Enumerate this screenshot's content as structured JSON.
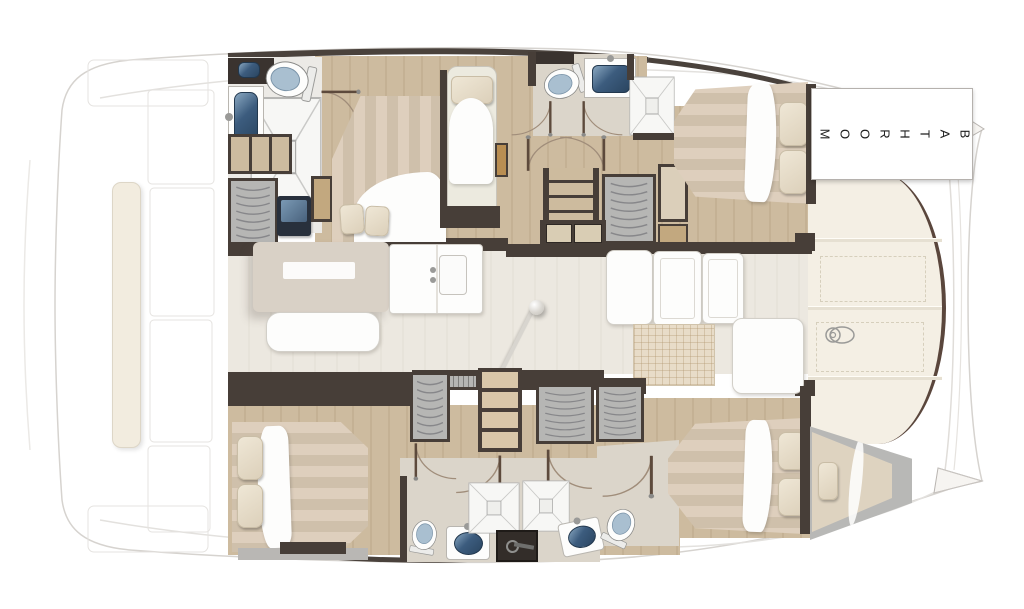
{
  "document": {
    "kind": "catamaran interior floor plan",
    "orientation": "bow to the right, two hulls with central saloon"
  },
  "labels": {
    "bathroom": "BATHROOM"
  },
  "palette": {
    "wall": "#473e38",
    "wood_floor": "#c9b79b",
    "saloon_floor": "#eae6dd",
    "bath_floor": "#dbd5ca",
    "bed_stripe_light": "#decfbd",
    "bed_stripe_dark": "#cfc0ab",
    "pillow": "#e9dfcc",
    "toilet_lid": "#a9bfd0",
    "sink_basin": "#3c5c7e",
    "locker_gray": "#b6b6b4",
    "deck_panel": "#f4efe4",
    "hull_edge": "#5a463c",
    "bench_cream": "#f2ecdf",
    "outline": "#d8d5d1",
    "label_text": "#1d1d1d"
  },
  "fixtures": [
    "double-bed",
    "single-berth",
    "forepeak-berth",
    "pillow",
    "duvet",
    "toilet",
    "sink",
    "shower",
    "hanging-locker",
    "shelf-unit",
    "stairs",
    "saloon-table",
    "bench-seat",
    "galley-counter",
    "grid-mat",
    "windlass",
    "door-swing",
    "mast-post",
    "tv-panel",
    "vanity",
    "aft-bench",
    "bow-hatch"
  ]
}
